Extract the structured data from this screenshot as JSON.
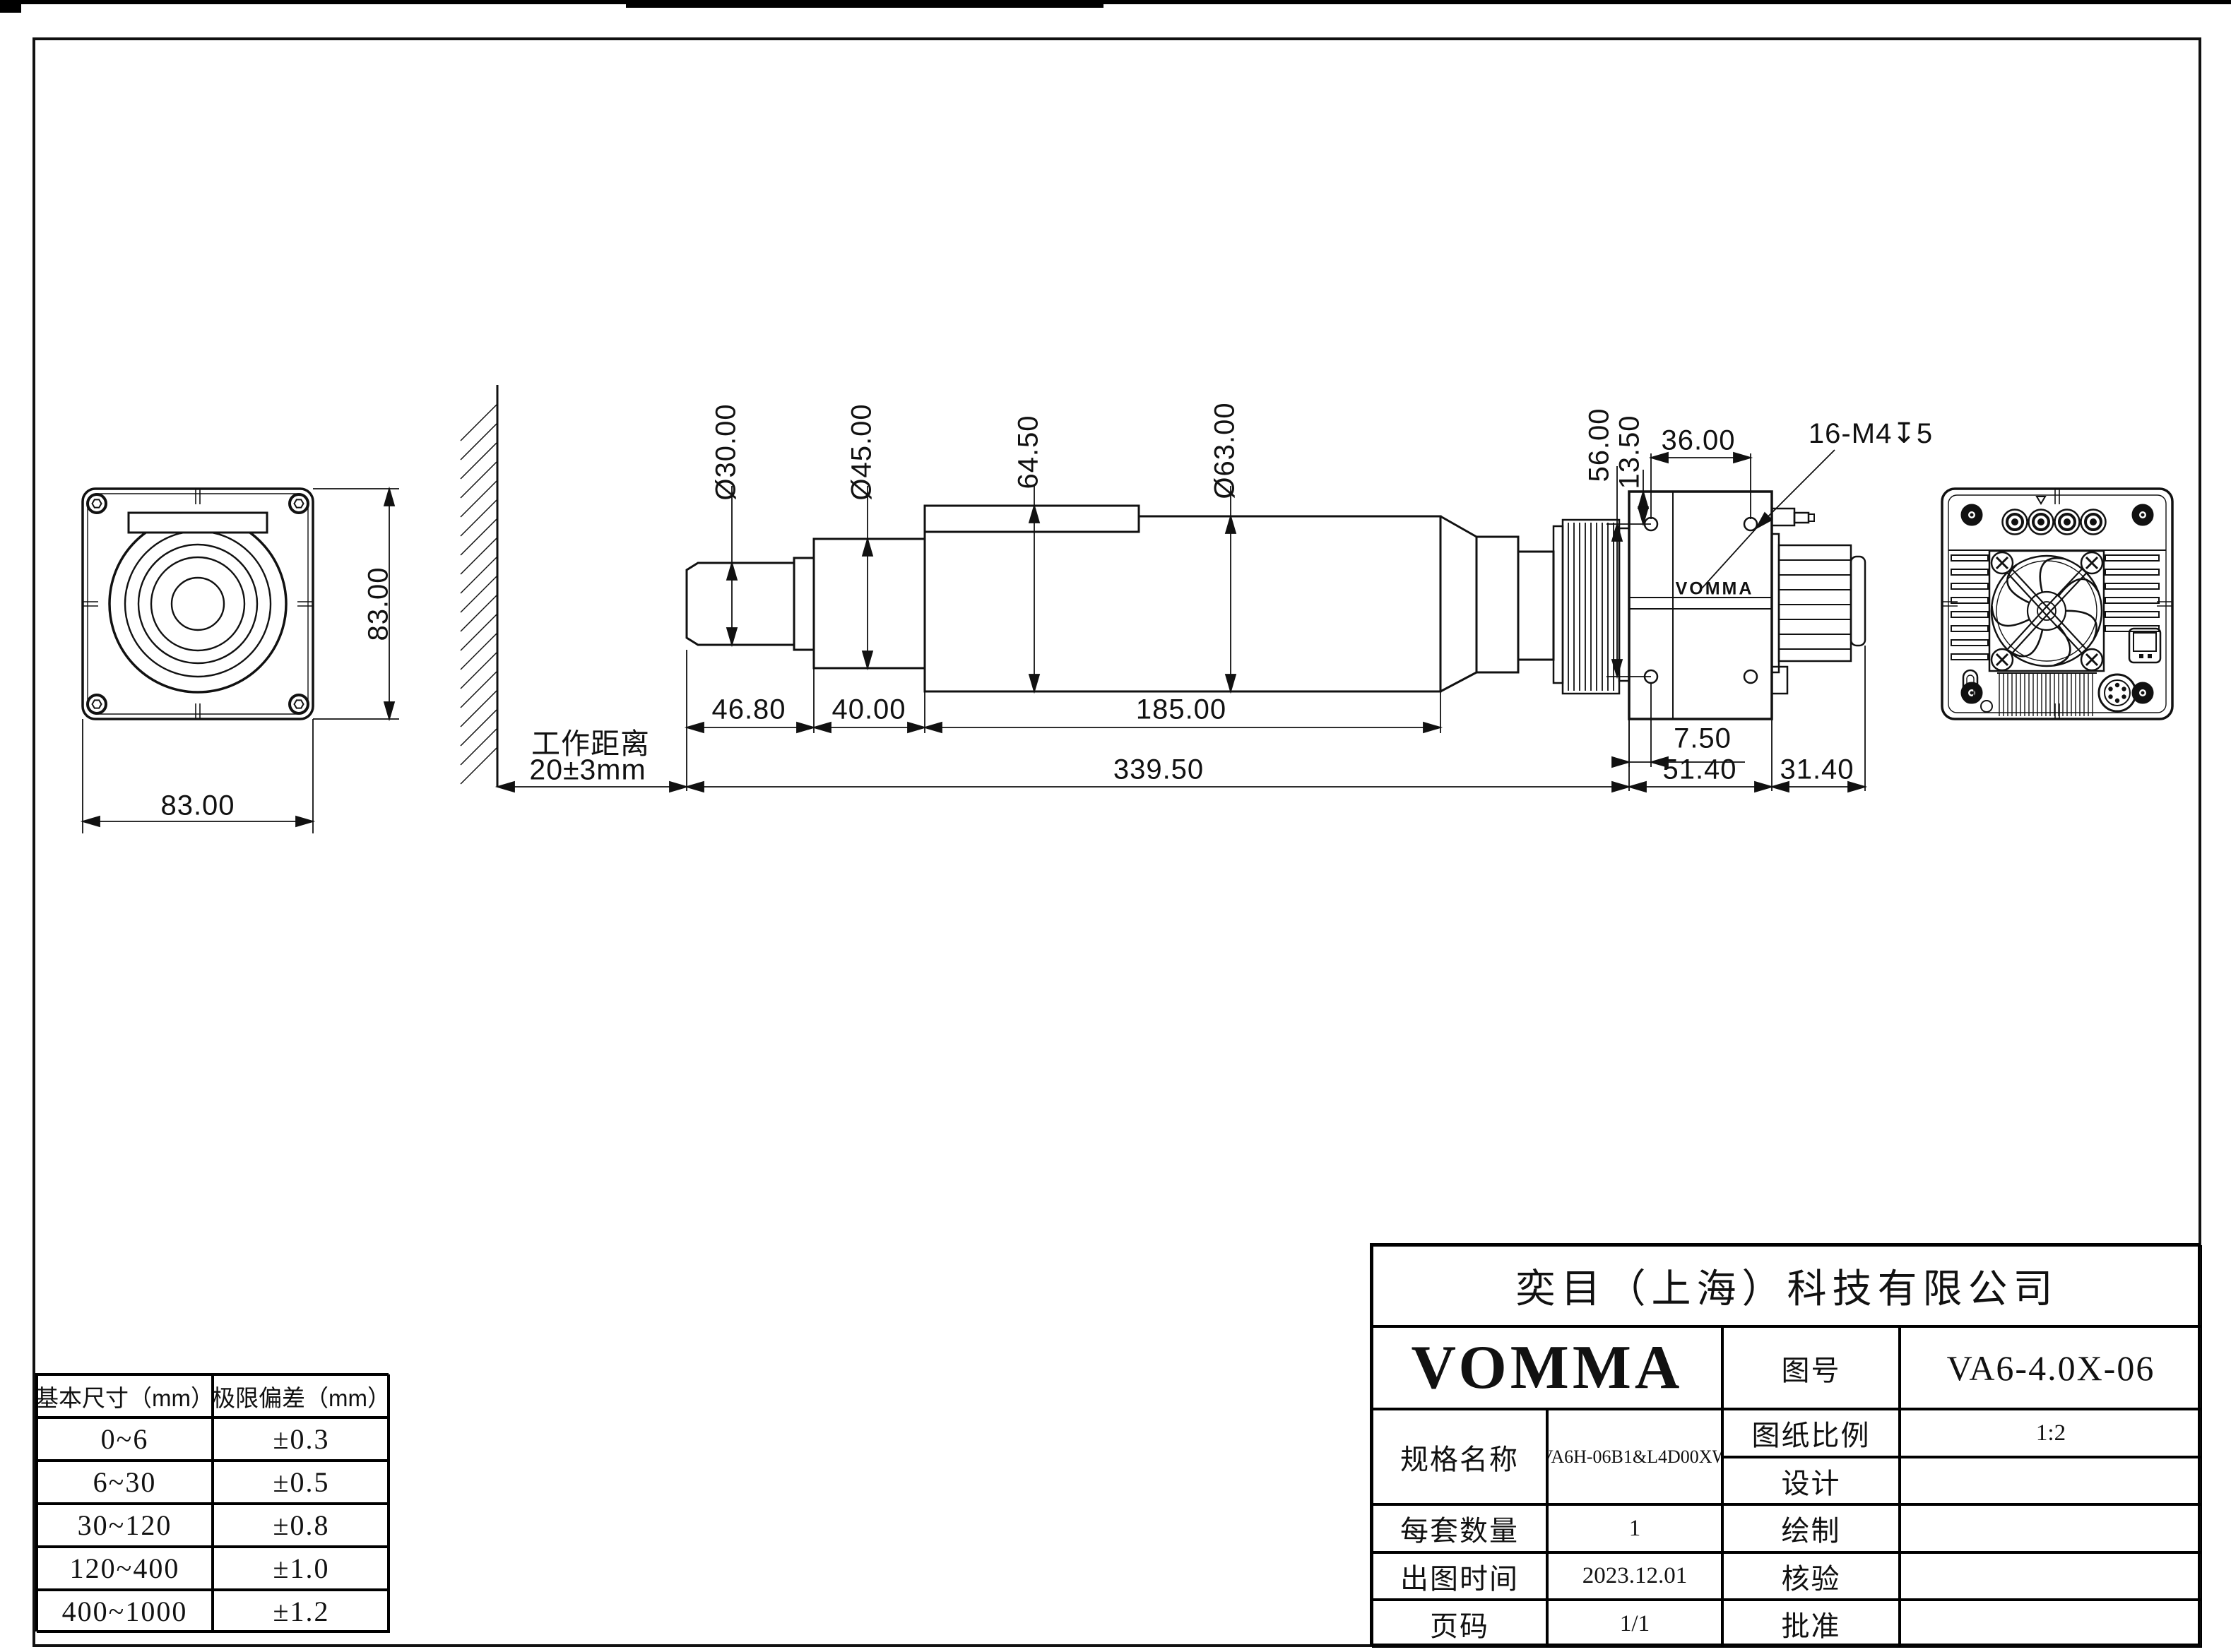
{
  "title_block": {
    "company": "奕目（上海）科技有限公司",
    "brand": "VOMMA",
    "drawing_no_label": "图号",
    "drawing_no": "VA6-4.0X-06",
    "spec_label": "规格名称",
    "spec": "VA6H-06B1&L4D00XW",
    "scale_label": "图纸比例",
    "scale": "1:2",
    "design_label": "设计",
    "design": "",
    "qty_label": "每套数量",
    "qty": "1",
    "draw_label": "绘制",
    "draw": "",
    "date_label": "出图时间",
    "date": "2023.12.01",
    "check_label": "核验",
    "check": "",
    "page_label": "页码",
    "page": "1/1",
    "approve_label": "批准",
    "approve": ""
  },
  "tolerance_table": {
    "headers": [
      "基本尺寸（mm）",
      "极限偏差（mm）"
    ],
    "rows": [
      [
        "0~6",
        "±0.3"
      ],
      [
        "6~30",
        "±0.5"
      ],
      [
        "30~120",
        "±0.8"
      ],
      [
        "120~400",
        "±1.0"
      ],
      [
        "400~1000",
        "±1.2"
      ]
    ]
  },
  "dims": {
    "front_width": "83.00",
    "front_height": "83.00",
    "d30": "Ø30.00",
    "d45": "Ø45.00",
    "d645": "64.50",
    "d63": "Ø63.00",
    "d56": "56.00",
    "d135": "13.50",
    "d36": "36.00",
    "thread": "16-M4↧5",
    "d468": "46.80",
    "d40": "40.00",
    "d185": "185.00",
    "d75": "7.50",
    "d3395": "339.50",
    "d514": "51.40",
    "d314": "31.40"
  },
  "working_distance": {
    "line1": "工作距离",
    "line2": "20±3mm"
  },
  "side_logo": "VOMMA"
}
